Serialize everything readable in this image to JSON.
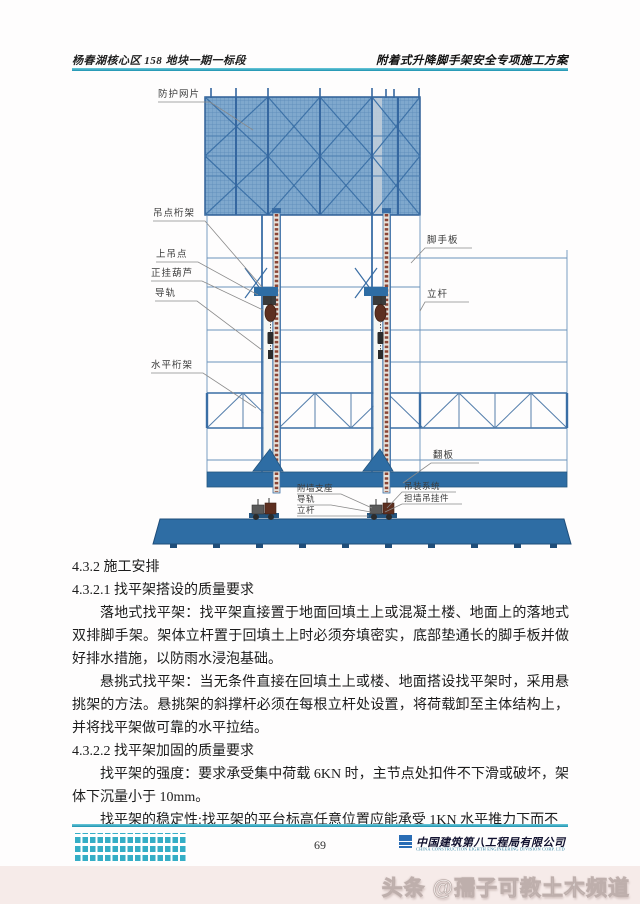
{
  "header": {
    "left": "杨春湖核心区 158 地块一期一标段",
    "right": "附着式升降脚手架安全专项施工方案"
  },
  "diagram": {
    "labels": {
      "protective_mesh": "防护网片",
      "lifting_point_truss": "吊点桁架",
      "upper_lifting_point": "上吊点",
      "chain_hoist": "正挂葫芦",
      "guide_rail_left": "导轨",
      "horizontal_truss": "水平桁架",
      "scaffold_board": "脚手板",
      "vertical_pole_right": "立杆",
      "flip_board": "翻板",
      "wall_attached_support": "附墙支座",
      "guide_rail_bottom": "导轨",
      "vertical_pole_bottom": "立杆",
      "hoisting_system": "吊装系统",
      "wall_hanger": "担墙吊挂件"
    }
  },
  "content": {
    "heading_432": "4.3.2 施工安排",
    "heading_4321": "4.3.2.1 找平架搭设的质量要求",
    "para_1": "落地式找平架：找平架直接置于地面回填土上或混凝土楼、地面上的落地式双排脚手架。架体立杆置于回填土上时必须夯填密实，底部垫通长的脚手板并做好排水措施，以防雨水浸泡基础。",
    "para_2": "悬挑式找平架：当无条件直接在回填土上或楼、地面搭设找平架时，采用悬挑架的方法。悬挑架的斜撑杆必须在每根立杆处设置，将荷载卸至主体结构上，并将找平架做可靠的水平拉结。",
    "heading_4322": "4.3.2.2 找平架加固的质量要求",
    "para_3": "找平架的强度：要求承受集中荷载 6KN 时，主节点处扣件不下滑或破坏，架体下沉量小于 10mm。",
    "para_4": "找平架的稳定性:找平架的平台标高任意位置应能承受 1KN 水平推力下而不"
  },
  "footer": {
    "page_number": "69",
    "company_cn": "中国建筑第八工程局有限公司",
    "company_en": "CHINA CONSTRUCTION EIGHTH ENGINEERING DIVISION CORP. LTD"
  },
  "watermark": "头条 @孺子可教土木频道",
  "colors": {
    "accent_teal": "#2fa9c2",
    "diagram_blue": "#3a6ea5",
    "mesh_fill": "#7fa8cd",
    "platform_blue": "#2e6da4",
    "rail_red": "#8b4434",
    "logo_blue": "#2a6db5"
  }
}
